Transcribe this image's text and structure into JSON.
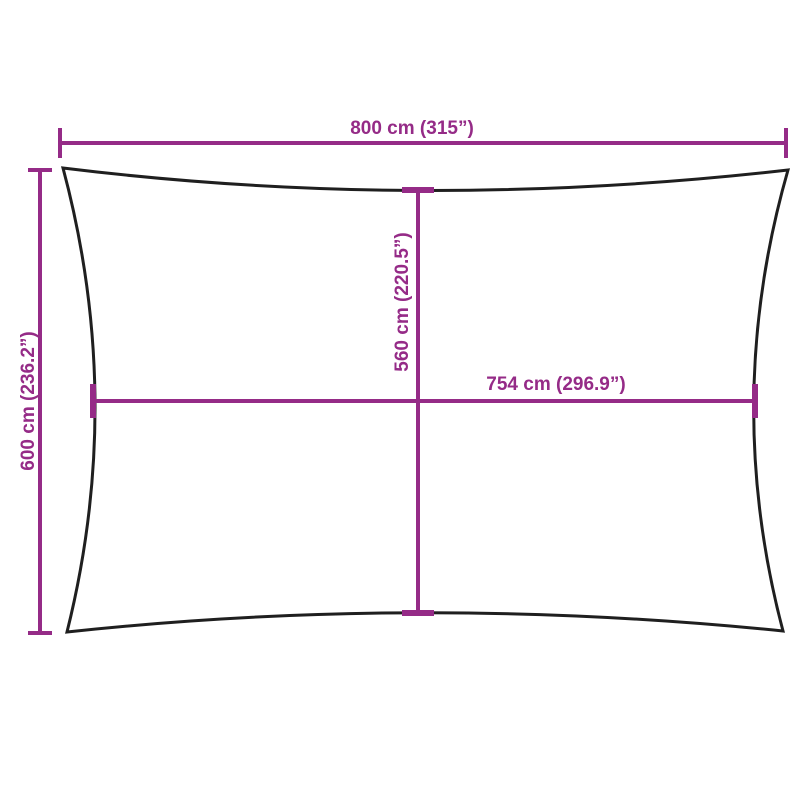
{
  "diagram": {
    "title": "Rectangular shade sail dimension drawing",
    "labels": {
      "top_width": "800 cm (315”)",
      "left_height": "600 cm (236.2”)",
      "inner_height": "560 cm (220.5”)",
      "inner_width": "754 cm (296.9”)"
    }
  },
  "colors": {
    "accent": "#952B87",
    "outline": "#1F1F1F",
    "background": "#FFFFFF"
  }
}
